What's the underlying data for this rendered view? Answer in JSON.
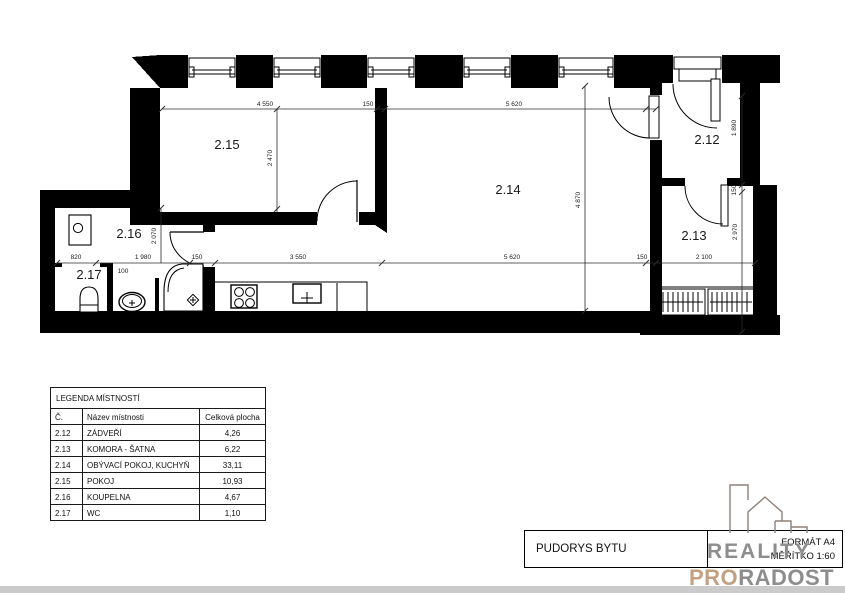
{
  "plan": {
    "labels": {
      "r212": "2.12",
      "r213": "2.13",
      "r214": "2.14",
      "r215": "2.15",
      "r216": "2.16",
      "r217": "2.17"
    },
    "dims": {
      "d4550": "4 550",
      "d150": "150",
      "d5620": "5 620",
      "d2470": "2 470",
      "d4870": "4 870",
      "d1890": "1 890",
      "d2970": "2 970",
      "d2070": "2 070",
      "d820": "820",
      "d1980": "1 980",
      "d100": "100",
      "d3550": "3 550",
      "d2100": "2 100"
    }
  },
  "legend": {
    "title": "LEGENDA MÍSTNOSTÍ",
    "columns": {
      "num": "Č.",
      "name": "Název místnosti",
      "area": "Celková plocha"
    },
    "rows": [
      {
        "num": "2.12",
        "name": "ZÁDVEŘÍ",
        "area": "4,26"
      },
      {
        "num": "2.13",
        "name": "KOMORA - ŠATNA",
        "area": "6,22"
      },
      {
        "num": "2.14",
        "name": "OBÝVACÍ POKOJ, KUCHYŇ",
        "area": "33,11"
      },
      {
        "num": "2.15",
        "name": "POKOJ",
        "area": "10,93"
      },
      {
        "num": "2.16",
        "name": "KOUPELNA",
        "area": "4,67"
      },
      {
        "num": "2.17",
        "name": "WC",
        "area": "1,10"
      }
    ]
  },
  "title_block": {
    "drawing_title": "PUDORYS BYTU",
    "format_label": "FORMÁT A4",
    "scale_label": "MĚŘÍTKO  1:60"
  },
  "logo": {
    "word1": "REALITY",
    "word2a": "PRO",
    "word2b": "RADOST"
  },
  "colors": {
    "wall": "#000000",
    "dimension": "#2b2b2b",
    "logo_gray": "#8d8d8d",
    "logo_tan": "#c2a183",
    "logo_outline": "#8d8177"
  }
}
